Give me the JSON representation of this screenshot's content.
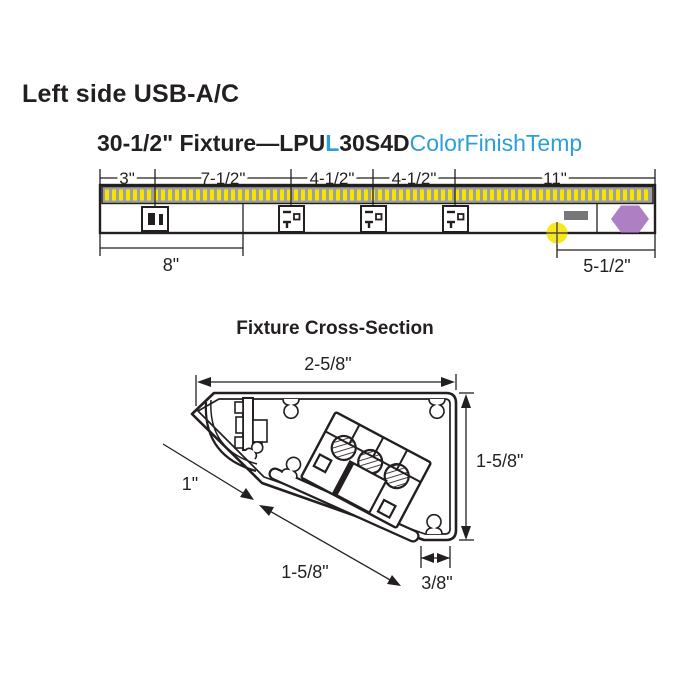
{
  "page": {
    "heading": "Left side USB-A/C"
  },
  "fixture": {
    "title": {
      "prefix": "30-1/2\" Fixture—LPU",
      "highlight": "L",
      "mid": "30S4D",
      "suffix": "ColorFinishTemp"
    },
    "dims_top": [
      "3\"",
      "7-1/2\"",
      "4-1/2\"",
      "4-1/2\"",
      "11\""
    ],
    "dims_bottom": {
      "left": "8\"",
      "right": "5-1/2\""
    },
    "components": {
      "led_strip": "led-tape-strip",
      "outlet_1": "usb-a-c-outlet",
      "outlet_2": "power-receptacle",
      "outlet_3": "power-receptacle",
      "outlet_4": "power-receptacle",
      "lead": "wire-lead",
      "marker": "mounting-point-marker",
      "end_cap": "end-cap-hexagon"
    },
    "colors": {
      "led_yellow": "#f7e400",
      "strip_gray": "#9c9ea0",
      "marker_yellow": "#f8e71c",
      "lead_gray": "#77777a",
      "endcap_purple": "#ae80c3"
    }
  },
  "cross_section": {
    "title": "Fixture Cross-Section",
    "dims": {
      "top": "2-5/8\"",
      "right": "1-5/8\"",
      "left": "1\"",
      "diagonal": "1-5/8\"",
      "bottom": "3/8\""
    }
  },
  "colors": {
    "text": "#231f20",
    "accent_blue": "#2b9fd8",
    "line": "#231f20"
  }
}
